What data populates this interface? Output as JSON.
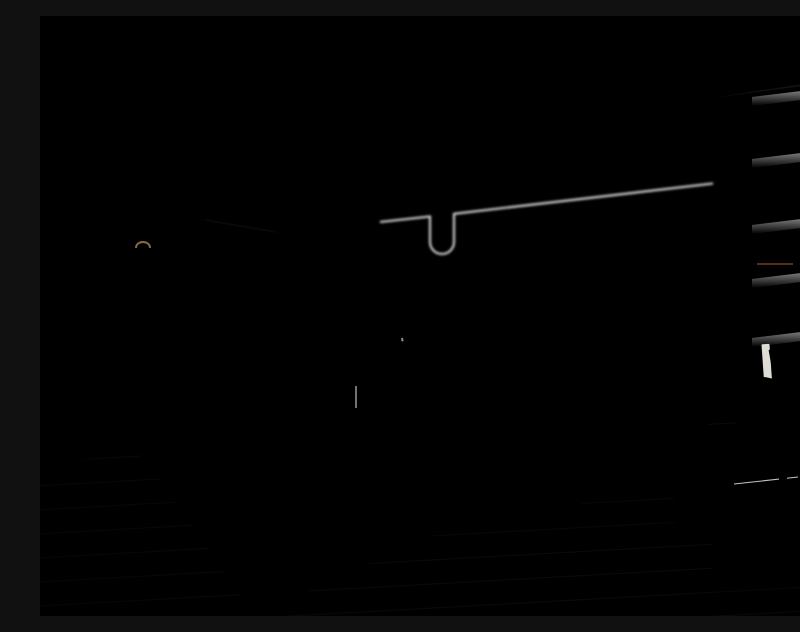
{
  "scene": {
    "type": "interior-photograph",
    "room": "modern chinese style bedroom",
    "objects": [
      "ceiling track lights",
      "cove lighting",
      "textured beige upper wall",
      "paneled headboard wall with LED trim",
      "fan-wave mural",
      "red berry branch decor",
      "wood wardrobe with lattice doors",
      "display niche with vase handbag and cap",
      "two arc pendant lamps",
      "upholstered bed with leather headboard",
      "pillows with teal lumbar accent",
      "striped throw runner",
      "oval gray nightstand",
      "white ceramic vase",
      "black cage table lamp",
      "foot bench with teal throw",
      "waterfall side table",
      "wood tray with pink decanter and glasses",
      "thin-leg side table",
      "area rug with branch pattern",
      "two pinecones",
      "green barrel armchair",
      "round wood side table with marble top",
      "gray teapot",
      "white storage box",
      "built-in black display shelf",
      "wood column panels",
      "oak plank floor"
    ]
  },
  "colors": {
    "ceiling-a": "#b9b6b4",
    "ceiling-b": "#dfdcd9",
    "cove": "#f8f4ec",
    "seam": "#807c78",
    "track": "#1a1a1a",
    "led": "#ffffff",
    "beige-a": "#d5caad",
    "beige-b": "#f1ead7",
    "beige-line": "#c4b795",
    "panel-a": "#ece5de",
    "panel-b": "#dcd4cb",
    "trim": "#8a684c",
    "glow": "#ffe3a6",
    "glow-soft": "#ffedc4",
    "mural-gray": "#8f8780",
    "mural-fill": "#cfc7bd",
    "mural-cream": "#ddcaa6",
    "mural-dark": "#6f5f4b",
    "berry": "#c84e29",
    "twig": "#5c4533",
    "wood-a": "#9c8261",
    "wood-b": "#856b4a",
    "wood-c": "#6c5637",
    "wood-line": "#51402a",
    "crown": "#a38966",
    "lattice-bg": "#2d251b",
    "slat": "#8b7150",
    "cloth-a": "#dedad3",
    "cloth-b": "#b7b5b0",
    "niche-red": "#732b27",
    "niche-shade": "#231b12",
    "brass": "#c6a265",
    "column-a": "#836946",
    "column-b": "#65502f",
    "column-line": "#4d3b25",
    "nook-bg": "#222527",
    "nook-dark": "#141617",
    "nook-glow": "#eef1f4",
    "sculpt": "#c7cbcf",
    "sculpt-dark": "#2b2e31",
    "box-red": "#5e2e22",
    "book": "#e9e6e1",
    "floor-a": "#53402b",
    "floor-b": "#73583b",
    "floor-c": "#8e7150",
    "floor-d": "#a38459",
    "plank-line": "#392b1a",
    "streak": "#ac8d5f",
    "mat": "#44423d",
    "rug-a": "#c6bdb6",
    "rug-b": "#d9cfc8",
    "rug-pink": "#dccdc4",
    "rug-seam": "#aaa098",
    "rug-line": "#2f2d2a",
    "pinecone": "#5e4026",
    "pinecone-hi": "#8a6138",
    "duvet-a": "#f0eeeb",
    "duvet-b": "#d5d2cd",
    "fold": "#bdbab4",
    "sheet": "#f8f7f5",
    "headboard-a": "#b0714a",
    "headboard-b": "#8f4f2e",
    "headboard-line": "#6e3a20",
    "frame-dark": "#2c2723",
    "pillow-a": "#c7c3bf",
    "pillow-b": "#a9a5a1",
    "pillow-w": "#eae8e4",
    "stripe": "#b3afa9",
    "teal": "#478678",
    "teal-b": "#2f6357",
    "runner-a": "#c57857",
    "runner-b": "#bd8d67",
    "runner-c": "#ead3c0",
    "bench-a": "#dcd8d2",
    "bench-b": "#c2beb8",
    "metal": "#2b2723",
    "gray-a": "#5d6064",
    "gray-b": "#45484c",
    "gray-c": "#303234",
    "tray": "#c18c54",
    "tray-b": "#9e6c3a",
    "pink": "#eab5c0",
    "pink-b": "#d897a6",
    "glass": "#d7d4cf",
    "chair-a": "#447a6d",
    "chair-b": "#2f5c51",
    "chair-c": "#5b9386",
    "cushion-a": "#f1eee7",
    "cushion-b": "#d9d5cd",
    "cyl-a": "#514034",
    "cyl-b": "#352a20",
    "notch": "#20180f",
    "marble": "#ece9e4",
    "marble-edge": "#b9b6b1",
    "marble-line": "#c2bfba",
    "teapot-a": "#9a9a9d",
    "teapot-b": "#6e6e71",
    "handle": "#c3ad8a",
    "boxw-a": "#f0ede6",
    "boxw-b": "#d9d5cc",
    "vase": "#f5f3ef",
    "cap": "#4a6e97",
    "cap-b": "#3c5a7e",
    "bag": "#b8905f",
    "lamp-glow": "#ffefcf",
    "lamp-body": "#fdf2dc",
    "cord": "#3c3c3c",
    "shadow": "#1f150c"
  }
}
